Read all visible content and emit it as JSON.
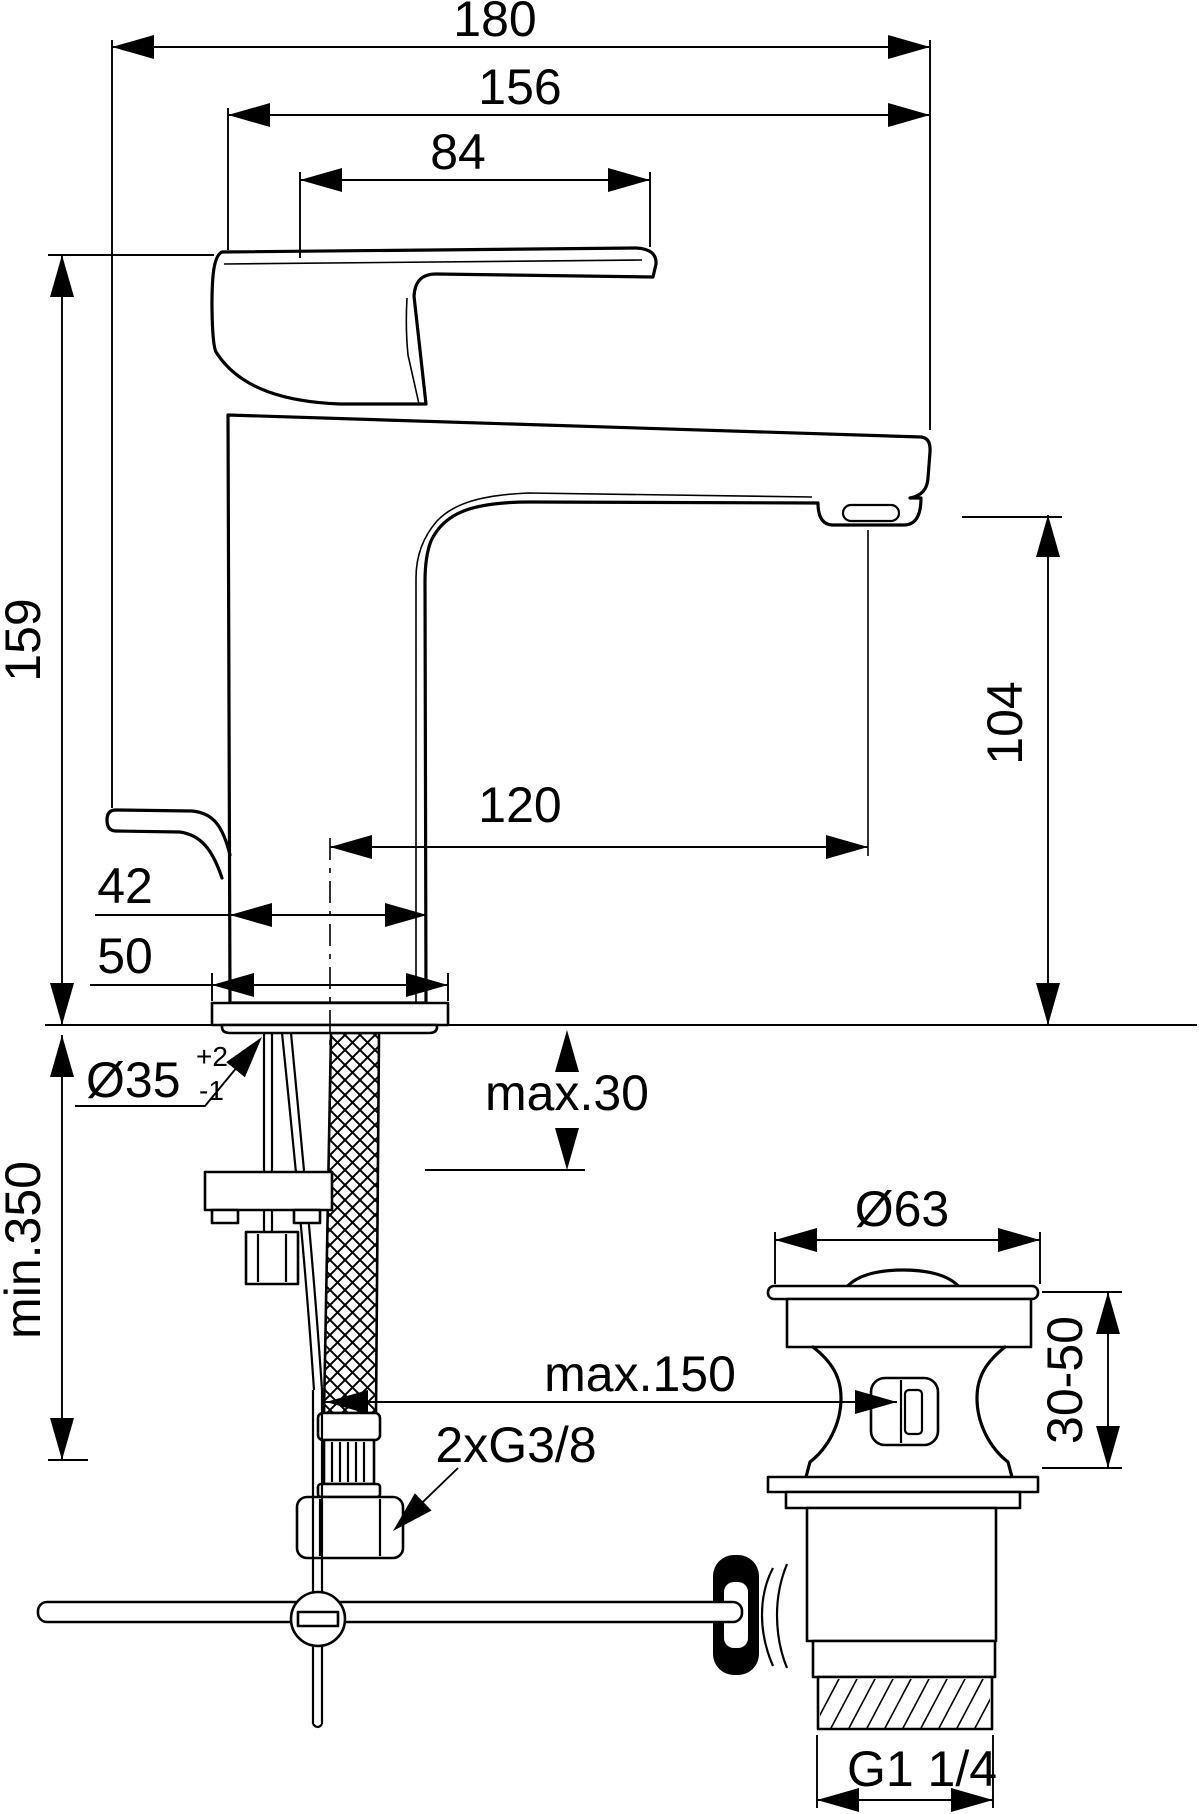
{
  "drawing": {
    "type": "technical-dimension-drawing",
    "subject": "single-lever basin mixer faucet with flexible supply hose and pop-up waste drain",
    "ink_color": "#000000",
    "background_color": "#ffffff"
  },
  "labels": {
    "d180": "180",
    "d156": "156",
    "d84": "84",
    "d159": "159",
    "min350": "min.350",
    "d42": "42",
    "d50": "50",
    "dia35": "Ø35",
    "dia35_sup": "+2",
    "dia35_sub": "-1",
    "max30": "max.30",
    "d120": "120",
    "d104": "104",
    "dia63": "Ø63",
    "max150": "max.150",
    "g38": "2xG3/8",
    "d3050": "30-50",
    "g114": "G1 1/4"
  }
}
